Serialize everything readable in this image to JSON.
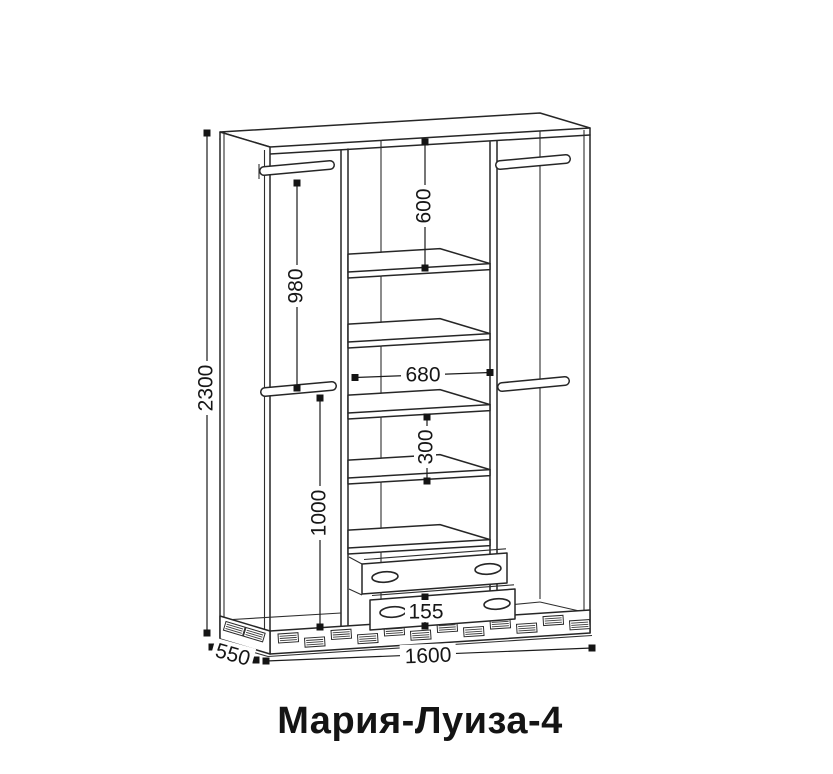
{
  "title": "Мария-Луиза-4",
  "dimensions": {
    "overall_height": "2300",
    "overall_width": "1600",
    "overall_depth": "550",
    "left_upper_rod_drop": "980",
    "left_lower_section": "1000",
    "center_top_gap": "600",
    "center_section_width": "680",
    "center_shelf_gap": "300",
    "drawer_front_height": "155"
  },
  "style": {
    "line_color": "#262626",
    "text_color": "#161616",
    "background": "#ffffff"
  }
}
